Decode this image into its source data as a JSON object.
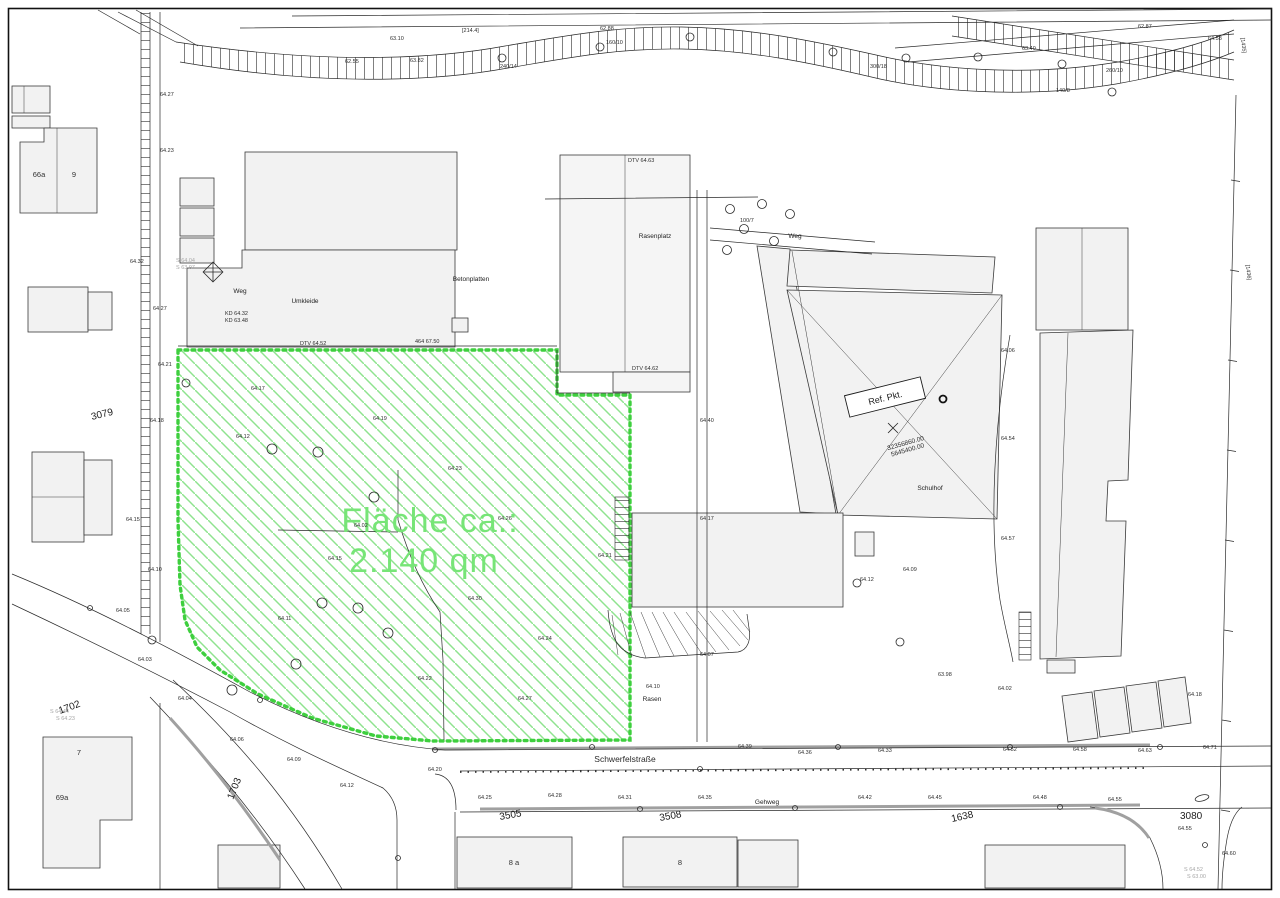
{
  "colors": {
    "hatch_green": "#8fe38f",
    "border_green": "#3ecf3e",
    "text_green": "#77e577",
    "building_fill": "#f2f2f2",
    "road_gray": "#a0a0a0",
    "linework": "#2a2a2a"
  },
  "area": {
    "label_line1": "Fläche ca.:",
    "label_line2": "2.140 qm"
  },
  "street": {
    "name": "Schwerfelstraße"
  },
  "ref_point": {
    "label": "Ref. Pkt.",
    "easting": "32356860.00",
    "northing": "5645400.00"
  },
  "parcel_numbers": [
    {
      "t": "1702",
      "x": 60,
      "y": 714,
      "r": -20
    },
    {
      "t": "1703",
      "x": 233,
      "y": 800,
      "r": -68
    },
    {
      "t": "3079",
      "x": 92,
      "y": 420,
      "r": -14
    },
    {
      "t": "3505",
      "x": 500,
      "y": 820,
      "r": -10
    },
    {
      "t": "3508",
      "x": 660,
      "y": 821,
      "r": -10
    },
    {
      "t": "1638",
      "x": 952,
      "y": 822,
      "r": -12
    },
    {
      "t": "3080",
      "x": 1180,
      "y": 819,
      "r": 0
    }
  ],
  "feature_labels": [
    {
      "t": "Umkleide",
      "x": 305,
      "y": 303
    },
    {
      "t": "Betonplatten",
      "x": 471,
      "y": 281,
      "s": 5.5
    },
    {
      "t": "Weg",
      "x": 795,
      "y": 238,
      "s": 5.5
    },
    {
      "t": "Weg",
      "x": 240,
      "y": 293,
      "s": 5.5
    },
    {
      "t": "Gehweg",
      "x": 767,
      "y": 804,
      "s": 5.5
    },
    {
      "t": "Schulhof",
      "x": 930,
      "y": 490,
      "s": 5.5
    },
    {
      "t": "Rasen",
      "x": 652,
      "y": 701,
      "s": 5.5
    },
    {
      "t": "Rasenplatz",
      "x": 655,
      "y": 238,
      "s": 5.5
    }
  ],
  "house_numbers": [
    {
      "t": "66a",
      "x": 39,
      "y": 177
    },
    {
      "t": "9",
      "x": 74,
      "y": 177
    },
    {
      "t": "7",
      "x": 79,
      "y": 755
    },
    {
      "t": "69a",
      "x": 62,
      "y": 800
    },
    {
      "t": "8 a",
      "x": 514,
      "y": 865
    },
    {
      "t": "8",
      "x": 680,
      "y": 865
    }
  ],
  "spot_labels": [
    {
      "t": "64.27",
      "x": 160,
      "y": 96
    },
    {
      "t": "64.23",
      "x": 160,
      "y": 152
    },
    {
      "t": "64.32",
      "x": 130,
      "y": 263
    },
    {
      "t": "64.27",
      "x": 153,
      "y": 310
    },
    {
      "t": "64.21",
      "x": 158,
      "y": 366
    },
    {
      "t": "64.18",
      "x": 150,
      "y": 422
    },
    {
      "t": "64.15",
      "x": 126,
      "y": 521
    },
    {
      "t": "64.10",
      "x": 148,
      "y": 571
    },
    {
      "t": "64.05",
      "x": 116,
      "y": 612
    },
    {
      "t": "64.03",
      "x": 138,
      "y": 661
    },
    {
      "t": "64.04",
      "x": 178,
      "y": 700
    },
    {
      "t": "64.06",
      "x": 230,
      "y": 741
    },
    {
      "t": "64.09",
      "x": 287,
      "y": 761
    },
    {
      "t": "64.12",
      "x": 340,
      "y": 787
    },
    {
      "t": "64.20",
      "x": 428,
      "y": 771
    },
    {
      "t": "63.10",
      "x": 390,
      "y": 40
    },
    {
      "t": "62.55",
      "x": 345,
      "y": 63
    },
    {
      "t": "[214.4]",
      "x": 462,
      "y": 32
    },
    {
      "t": "62.88",
      "x": 600,
      "y": 30
    },
    {
      "t": "62.87",
      "x": 1138,
      "y": 28
    },
    {
      "t": "63.40",
      "x": 1022,
      "y": 50
    },
    {
      "t": "240/14",
      "x": 500,
      "y": 68
    },
    {
      "t": "160/10",
      "x": 606,
      "y": 44
    },
    {
      "t": "300/18",
      "x": 870,
      "y": 68
    },
    {
      "t": "260/10",
      "x": 1106,
      "y": 72
    },
    {
      "t": "140/8",
      "x": 1056,
      "y": 92
    },
    {
      "t": "63.82",
      "x": 410,
      "y": 62
    },
    {
      "t": "64.58",
      "x": 1208,
      "y": 40
    },
    {
      "t": "DTV 64.63",
      "x": 628,
      "y": 162
    },
    {
      "t": "DTV 64.62",
      "x": 632,
      "y": 370
    },
    {
      "t": "64.40",
      "x": 700,
      "y": 422
    },
    {
      "t": "64.17",
      "x": 700,
      "y": 520
    },
    {
      "t": "64.07",
      "x": 700,
      "y": 656
    },
    {
      "t": "KD 64.32",
      "x": 225,
      "y": 315
    },
    {
      "t": "KD 63.48",
      "x": 225,
      "y": 322
    },
    {
      "t": "DTV 64.52",
      "x": 300,
      "y": 345
    },
    {
      "t": "464 67.50",
      "x": 415,
      "y": 343
    },
    {
      "t": "64.39",
      "x": 738,
      "y": 748
    },
    {
      "t": "64.36",
      "x": 798,
      "y": 754
    },
    {
      "t": "64.33",
      "x": 878,
      "y": 752
    },
    {
      "t": "64.52",
      "x": 1003,
      "y": 751
    },
    {
      "t": "64.58",
      "x": 1073,
      "y": 751
    },
    {
      "t": "64.63",
      "x": 1138,
      "y": 752
    },
    {
      "t": "64.71",
      "x": 1203,
      "y": 749
    },
    {
      "t": "64.25",
      "x": 478,
      "y": 799
    },
    {
      "t": "64.28",
      "x": 548,
      "y": 797
    },
    {
      "t": "64.31",
      "x": 618,
      "y": 799
    },
    {
      "t": "64.35",
      "x": 698,
      "y": 799
    },
    {
      "t": "64.42",
      "x": 858,
      "y": 799
    },
    {
      "t": "64.45",
      "x": 928,
      "y": 799
    },
    {
      "t": "64.48",
      "x": 1033,
      "y": 799
    },
    {
      "t": "64.55",
      "x": 1108,
      "y": 801
    },
    {
      "t": "64.55",
      "x": 1178,
      "y": 830
    },
    {
      "t": "64.60",
      "x": 1222,
      "y": 855
    },
    {
      "t": "64.06",
      "x": 1001,
      "y": 352
    },
    {
      "t": "64.54",
      "x": 1001,
      "y": 440
    },
    {
      "t": "64.57",
      "x": 1001,
      "y": 540
    },
    {
      "t": "64.09",
      "x": 903,
      "y": 571
    },
    {
      "t": "64.12",
      "x": 860,
      "y": 581
    },
    {
      "t": "63.98",
      "x": 938,
      "y": 676
    },
    {
      "t": "64.02",
      "x": 998,
      "y": 690
    },
    {
      "t": "64.18",
      "x": 1188,
      "y": 696
    },
    {
      "t": "64.10",
      "x": 646,
      "y": 688
    },
    {
      "t": "S 64.44",
      "x": 50,
      "y": 713,
      "c": 1
    },
    {
      "t": "S 64.23",
      "x": 56,
      "y": 720,
      "c": 1
    },
    {
      "t": "S 64.52",
      "x": 1184,
      "y": 871,
      "c": 1
    },
    {
      "t": "S 63.00",
      "x": 1187,
      "y": 878,
      "c": 1
    },
    {
      "t": "S 64.04",
      "x": 176,
      "y": 262,
      "c": 1
    },
    {
      "t": "S 63.97",
      "x": 176,
      "y": 269,
      "c": 1
    },
    {
      "t": "100/7",
      "x": 740,
      "y": 222
    },
    {
      "t": "[1435]",
      "x": 1241,
      "y": 38,
      "r": 83
    },
    {
      "t": "[1436]",
      "x": 1246,
      "y": 265,
      "r": 83
    },
    {
      "t": "64.17",
      "x": 251,
      "y": 390
    },
    {
      "t": "64.12",
      "x": 236,
      "y": 438
    },
    {
      "t": "64.02",
      "x": 354,
      "y": 527
    },
    {
      "t": "64.19",
      "x": 373,
      "y": 420
    },
    {
      "t": "64.23",
      "x": 448,
      "y": 470
    },
    {
      "t": "64.26",
      "x": 498,
      "y": 520
    },
    {
      "t": "64.15",
      "x": 328,
      "y": 560
    },
    {
      "t": "64.11",
      "x": 278,
      "y": 620
    },
    {
      "t": "64.22",
      "x": 418,
      "y": 680
    },
    {
      "t": "64.27",
      "x": 518,
      "y": 700
    },
    {
      "t": "64.30",
      "x": 468,
      "y": 600
    },
    {
      "t": "64.24",
      "x": 538,
      "y": 640
    },
    {
      "t": "64.21",
      "x": 598,
      "y": 557
    }
  ]
}
